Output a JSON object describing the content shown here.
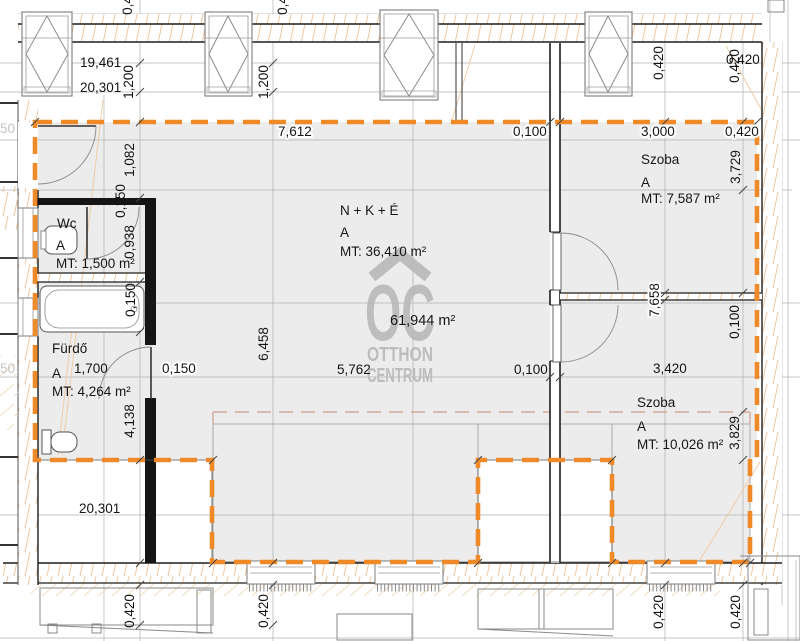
{
  "watermark": {
    "initials": "OC",
    "line1": "OTTHON",
    "line2": "CENTRUM"
  },
  "total_area": "61,944 m²",
  "rooms": {
    "wc": {
      "name": "Wc",
      "zone": "A",
      "area": "MT: 1,500 m²"
    },
    "furdo": {
      "name": "Fürdő",
      "zone": "A",
      "area": "MT: 4,264 m²"
    },
    "living": {
      "name": "N + K + É",
      "zone": "A",
      "area": "MT: 36,410 m²"
    },
    "szoba1": {
      "name": "Szoba",
      "zone": "A",
      "area": "MT: 7,587 m²"
    },
    "szoba2": {
      "name": "Szoba",
      "zone": "A",
      "area": "MT: 10,026 m²"
    }
  },
  "dims": {
    "t19461": "19,461",
    "t20301": "20,301",
    "v1200a": "1,200",
    "v1200b": "1,200",
    "cut04a": "0,420",
    "cut04b": "0,420",
    "e7612": "7,612",
    "e0100": "0,100",
    "e3000": "3,000",
    "e0420": "0,420",
    "rh0420": "0,420",
    "rv0420a": "0,420",
    "rv0420b": "0,420",
    "v3729": "3,729",
    "v1082": "1,082",
    "v0150a": "0,150",
    "v0938": "0,938",
    "v0150b": "0,150",
    "v6458": "6,458",
    "v7658": "7,658",
    "rv0100": "0,100",
    "f1700": "1,700",
    "f0150": "0,150",
    "m5762": "5,762",
    "m0100": "0,100",
    "m3420": "3,420",
    "v4138": "4,138",
    "v3829": "3,829",
    "b20301": "20,301",
    "bv0420a": "0,420",
    "bv0420b": "0,420",
    "bv0420c": "0,420",
    "bv0420d": "0,420",
    "cut50a": "50",
    "cut50b": "50"
  },
  "colors": {
    "envelope_dash": "#f08a28",
    "room_fill": "#ececec",
    "hatch": "#eec296",
    "canopy_dash": "#cf9d8b",
    "watermark": "#b9b9b9"
  }
}
